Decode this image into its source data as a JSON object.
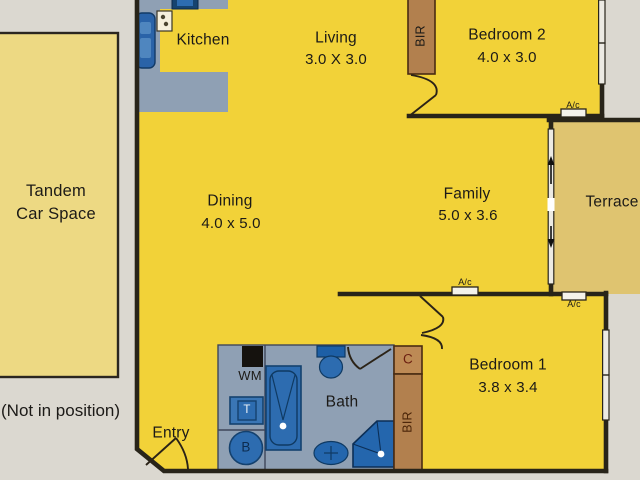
{
  "title": "Apartment floor plan",
  "rooms": {
    "kitchen": {
      "name": "Kitchen"
    },
    "living": {
      "name": "Living",
      "dims": "3.0 X 3.0"
    },
    "bedroom2": {
      "name": "Bedroom 2",
      "dims": "4.0 x 3.0"
    },
    "dining": {
      "name": "Dining",
      "dims": "4.0 x 5.0"
    },
    "family": {
      "name": "Family",
      "dims": "5.0 x 3.6"
    },
    "terrace": {
      "name": "Terrace"
    },
    "bedroom1": {
      "name": "Bedroom 1",
      "dims": "3.8 x 3.4"
    },
    "bath": {
      "name": "Bath"
    },
    "entry": {
      "name": "Entry"
    },
    "car_space": {
      "line1": "Tandem",
      "line2": "Car Space",
      "note": "(Not in position)"
    }
  },
  "markers": {
    "bir": "BIR",
    "closet": "C",
    "washing_machine": "WM",
    "trough": "T",
    "basin": "B",
    "aircon": "A/c"
  },
  "colors": {
    "background": "#dbd8d0",
    "unit_floor": "#f2d238",
    "terrace_floor": "#dfc470",
    "car_space_floor": "#edd983",
    "wet_area_gray": "#8fa0b4",
    "fixture_blue": "#2d6cb0",
    "fixture_blue_dark": "#14416e",
    "robe_brown": "#b2804e",
    "wall": "#282419"
  }
}
